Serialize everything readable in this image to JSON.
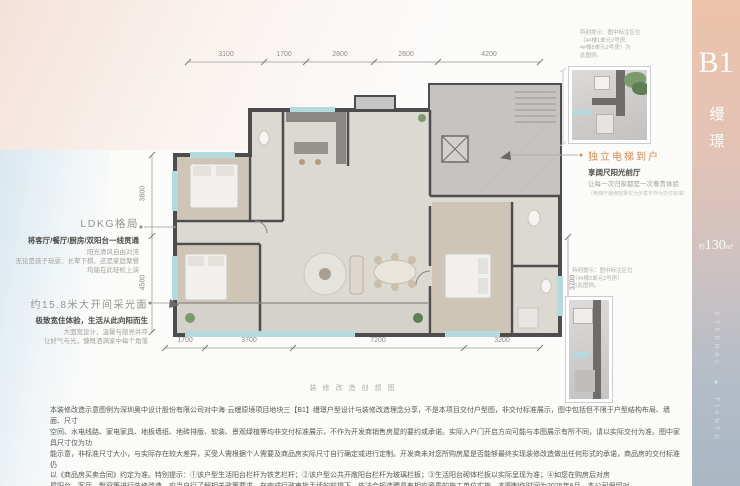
{
  "sidebar": {
    "unit": "B1",
    "series_vertical": "缦璟",
    "area": {
      "prefix": "约",
      "value": "130",
      "unit": "m²"
    },
    "watermark": {
      "top": "ETERNAL",
      "bottom": "TIANFU",
      "ornament": "✦"
    },
    "colors": {
      "top": "#ecc3ab",
      "bottom": "#aab7c4"
    }
  },
  "dimensions": {
    "top": [
      "3100",
      "1700",
      "2800",
      "2600",
      "4200"
    ],
    "bottom": [
      "1700",
      "3700",
      "7200",
      "3200"
    ],
    "left": [
      "3800",
      "4500"
    ],
    "right": [
      "3700"
    ]
  },
  "annotations": {
    "ldkg": {
      "title": "LDKG格局",
      "headline": "将客厅/餐厅/厨房/双阳台一线贯通",
      "lines": [
        "阳光清风自由对流",
        "无论是孩子玩耍、长辈下棋、还是家庭聚餐",
        "均能在此轻松上演"
      ]
    },
    "lighting": {
      "title": "约15.8米大开间采光面",
      "headline": "极致宽住体验，生活从此向阳而生",
      "lines": [
        "大面宽设计，温馨与敞亮并存",
        "让好气与光，慷慨洒满家中每个角落"
      ]
    },
    "elevator": {
      "title": "独立电梯到户",
      "headline": "享阔尺阳光前厅",
      "line": "让每一次归家都是一次尊贵体验",
      "note": "（电梯厅装修效果仅为示意不作为交付标准）"
    },
    "inset_note_1": {
      "lines": [
        "特别提示：图中标注区位",
        "（4#楼1单元2号房、",
        "4#楼5单元2号房）为",
        "此图例。"
      ]
    },
    "inset_note_2": {
      "lines": [
        "特别提示：图中标注区位",
        "（4#楼2单元2号房）",
        "为此图例。"
      ]
    }
  },
  "caption": "装修改造创想图",
  "disclaimer": {
    "lines": [
      "本装修改造示意图例为深圳奥中设计股份有限公司对中海·云缦原境项目地块三【B1】缦璟户型设计与装修改造理念分享，不是本项目交付户型图，非交付标准展示，图中包括但不限于户型结构布局、墙面、尺寸",
      "空间、水电线路、家电家具、地板墙纸、地砖排版、软装、景观绿植等均非交付标准展示，不作为开发商销售房屋的要约或承诺。实际入户门开启方向可能与本图展示有所不同，请以实际交付为准。图中家具尺寸仅为功",
      "能示意，非标准尺寸大小，与实际存在较大差异，买受人需根据个人需要及商品房实际尺寸自行确定或进行定制。开发商未对您所购房屋是否能够最终实现装修改造做出任何形式的承诺，商品房的交付标准仍",
      "以《商品房买卖合同》约定为准。特别提示：①该户型生活阳台栏杆为铁艺栏杆；②该户型公共开敞阳台栏杆为玻璃栏板；③生活阳台砌体栏板以实际呈现为准；④如您在购房后对房",
      "屋阳台、客厅、飘窗等进行装修改造，应当自行了解相关政策要求，在完成行政审批手续的前提下，依法合规选聘具有相应资质的施工单位实施。本图制作时间为2025年6月，本公司保留对",
      "一切未展示或已展示事项的更改，不再另行通知，敬请主动留意最新资料。开发商：成都璟毓置业有限公司。预售证号：首预售字第510110202576033号。"
    ]
  }
}
